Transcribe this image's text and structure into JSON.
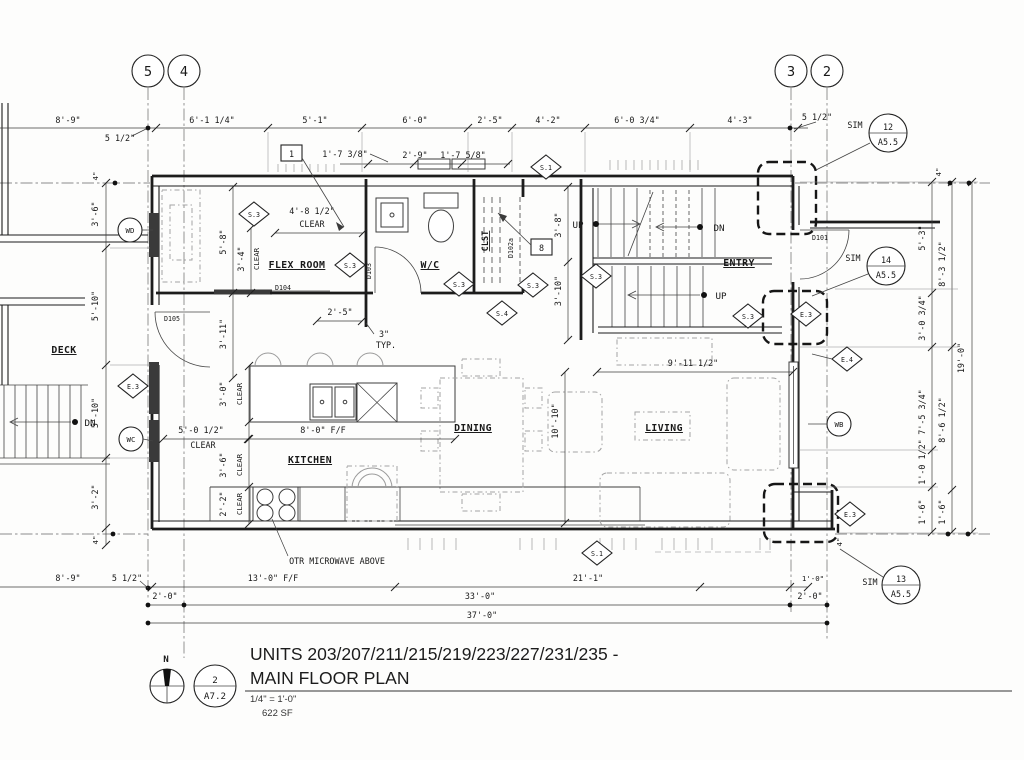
{
  "meta": {
    "title_line1": "UNITS 203/207/211/215/219/223/227/231/235 -",
    "title_line2": "MAIN FLOOR PLAN",
    "scale": "1/4\" = 1'-0\"",
    "area": "622 SF",
    "sheet_no": "2",
    "sheet_ref": "A7.2",
    "north": "N"
  },
  "grid": {
    "b5": "5",
    "b4": "4",
    "b3": "3",
    "b2": "2"
  },
  "rooms": {
    "deck": "DECK",
    "flex": "FLEX ROOM",
    "wc": "W/C",
    "clst": "CLST",
    "entry": "ENTRY",
    "kitchen": "KITCHEN",
    "dining": "DINING",
    "living": "LIVING"
  },
  "doors": {
    "d101": "D101",
    "d102a": "D102a",
    "d103": "D103",
    "d104": "D104",
    "d105": "D105"
  },
  "tags": {
    "wd": "WD",
    "wc": "WC",
    "wb": "WB",
    "sim": "SIM",
    "s1": "S.1",
    "s3": "S.3",
    "s4": "S.4",
    "e3": "E.3",
    "e4": "E.4",
    "c1": "1",
    "c8": "8",
    "n12": "12",
    "n13": "13",
    "n14": "14",
    "a55": "A5.5"
  },
  "stairs": {
    "up": "UP",
    "dn": "DN"
  },
  "notes": {
    "otr": "OTR MICROWAVE ABOVE",
    "clear": "CLEAR",
    "typ": "TYP.",
    "three": "3\""
  },
  "dims": {
    "top": [
      "8'-9\"",
      "5 1/2\"",
      "6'-1 1/4\"",
      "5'-1\"",
      "6'-0\"",
      "2'-5\"",
      "4'-2\"",
      "6'-0 3/4\"",
      "4'-3\"",
      "5 1/2\""
    ],
    "top2": [
      "1'-7 3/8\"",
      "2'-9\"",
      "1'-7 5/8\""
    ],
    "left": [
      "4\"",
      "3'-6\"",
      "5'-10\"",
      "5'-10\"",
      "3'-2\"",
      "4\""
    ],
    "right1": [
      "5'-3\"",
      "3'-0 3/4\"",
      "7'-5 3/4\"",
      "1'-0 1/2\"",
      "1'-6\""
    ],
    "right2": [
      "8'-3 1/2\"",
      "8'-6 1/2\"",
      "1'-6\""
    ],
    "right3": "19'-0\"",
    "right4top": "4\"",
    "right4bot": "4\"",
    "bottom1": [
      "13'-0\" F/F",
      "21'-1\"",
      "1'-0\""
    ],
    "bottom2": [
      "2'-0\"",
      "33'-0\"",
      "2'-0\""
    ],
    "bottom3": "37'-0\"",
    "bottom_left": [
      "8'-9\"",
      "5 1/2\""
    ],
    "inner": {
      "flexw": "4'-8 1/2\"",
      "flexh": "5'-8\"",
      "c34": "3'-4\"",
      "c25": "2'-5\"",
      "c311": "3'-11\"",
      "c38": "3'-8\"",
      "c310": "3'-10\"",
      "entryw": "9'-11 1/2\"",
      "livh": "10'-10\"",
      "k1": "5'-0 1/2\"",
      "k2": "8'-0\" F/F",
      "k3": "3'-0\"",
      "k4": "3'-6\"",
      "k5": "2'-2\""
    }
  }
}
